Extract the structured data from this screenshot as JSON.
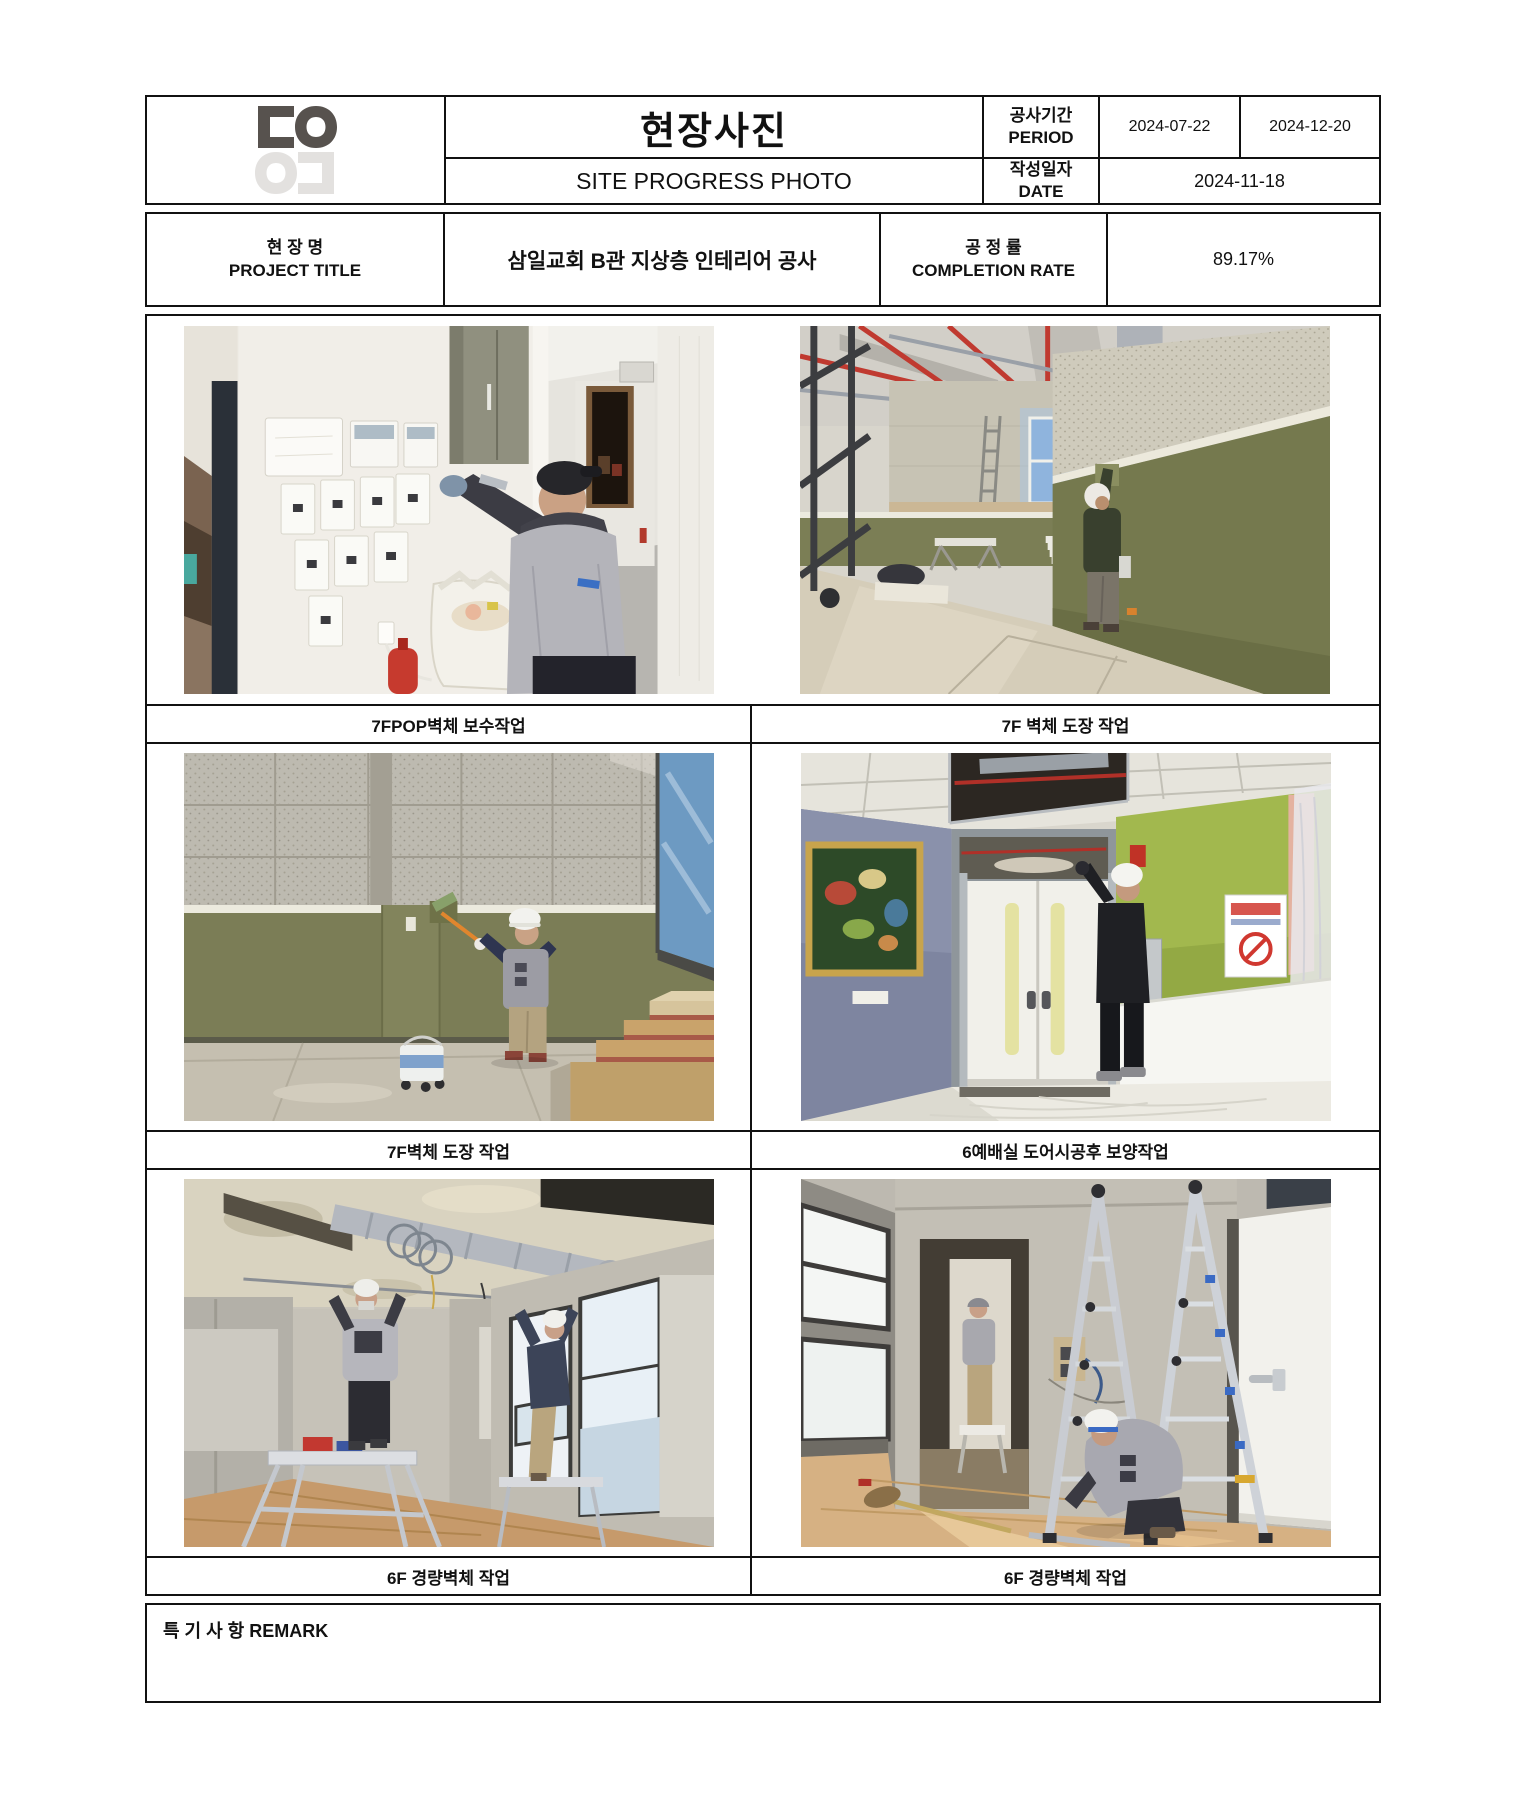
{
  "logo": {
    "top": "ㄷO",
    "bottom": "Oㄷ"
  },
  "header": {
    "title_ko": "현장사진",
    "title_en": "SITE PROGRESS PHOTO",
    "period_label": "공사기간\nPERIOD",
    "period_label_ko": "공사기간",
    "period_label_en": "PERIOD",
    "period_start": "2024-07-22",
    "period_end": "2024-12-20",
    "date_label_ko": "작성일자",
    "date_label_en": "DATE",
    "date_value": "2024-11-18",
    "project_label_ko": "현 장 명",
    "project_label_en": "PROJECT TITLE",
    "project_title": "삼일교회 B관 지상층 인테리어 공사",
    "completion_label_ko": "공 정 률",
    "completion_label_en": "COMPLETION RATE",
    "completion_value": "89.17%"
  },
  "photos": [
    {
      "caption": "7FPOP벽체 보수작업"
    },
    {
      "caption": "7F 벽체 도장 작업"
    },
    {
      "caption": "7F벽체 도장 작업"
    },
    {
      "caption": "6예배실 도어시공후 보양작업"
    },
    {
      "caption": "6F 경량벽체 작업"
    },
    {
      "caption": "6F 경량벽체 작업"
    }
  ],
  "remark": {
    "label": "특 기 사 항 REMARK",
    "content": ""
  },
  "colors": {
    "border": "#111111",
    "olive_wall": "#7b7e55",
    "logo_dark": "#57524e",
    "logo_light": "#e3e1df"
  }
}
